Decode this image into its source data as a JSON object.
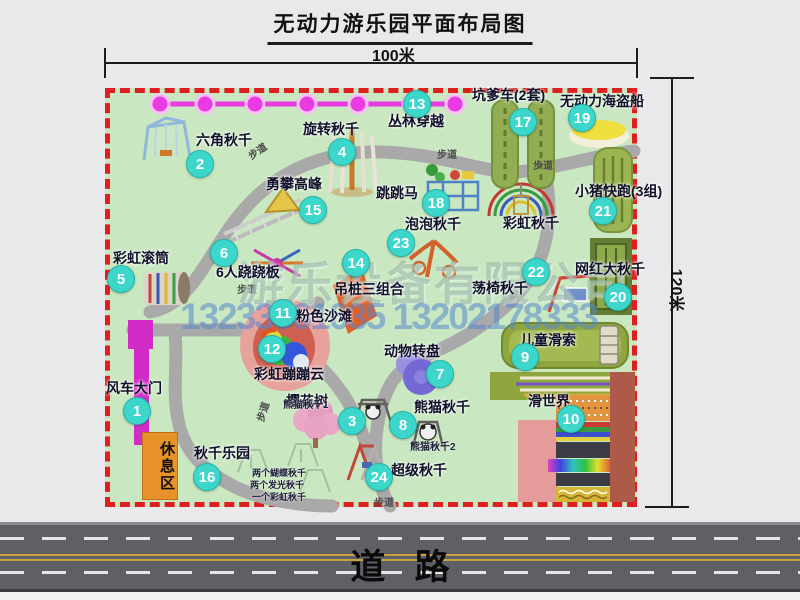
{
  "title": "无动力游乐园平面布局图",
  "dimensions": {
    "width_label": "100米",
    "height_label": "120米"
  },
  "road": {
    "label": "道   路"
  },
  "watermark": {
    "company": "游乐设备有限公司",
    "phones": "13233861635 13202178333"
  },
  "rest_area_label": "休息区",
  "colors": {
    "map_background": "#c9e7c0",
    "map_border": "#de1f1f",
    "marker": "#3cd6cb",
    "gate": "#d22cc6",
    "rest_area": "#e8922a",
    "road": "#5f5f66",
    "chain": "#ea3be2"
  },
  "map": {
    "pois": [
      {
        "num": "1",
        "label": "风车大门",
        "cx": 137,
        "cy": 411,
        "lx": 106,
        "ly": 381
      },
      {
        "num": "2",
        "label": "六角秋千",
        "cx": 200,
        "cy": 164,
        "lx": 196,
        "ly": 133
      },
      {
        "num": "3",
        "label": "樱花树",
        "cx": 352,
        "cy": 421,
        "lx": 286,
        "ly": 394
      },
      {
        "num": "4",
        "label": "旋转秋千",
        "cx": 342,
        "cy": 152,
        "lx": 303,
        "ly": 122
      },
      {
        "num": "5",
        "label": "彩虹滚筒",
        "cx": 121,
        "cy": 279,
        "lx": 113,
        "ly": 251
      },
      {
        "num": "6",
        "label": "6人跷跷板",
        "cx": 224,
        "cy": 253,
        "lx": 216,
        "ly": 265
      },
      {
        "num": "7",
        "label": "动物转盘",
        "cx": 440,
        "cy": 374,
        "lx": 384,
        "ly": 344
      },
      {
        "num": "8",
        "label": "熊猫秋千",
        "cx": 403,
        "cy": 425,
        "lx": 414,
        "ly": 400
      },
      {
        "num": "9",
        "label": "儿童滑索",
        "cx": 525,
        "cy": 357,
        "lx": 520,
        "ly": 333
      },
      {
        "num": "10",
        "label": "滑世界",
        "cx": 571,
        "cy": 419,
        "lx": 528,
        "ly": 394
      },
      {
        "num": "11",
        "label": "粉色沙滩",
        "cx": 283,
        "cy": 313,
        "lx": 296,
        "ly": 309
      },
      {
        "num": "12",
        "label": "彩虹蹦蹦云",
        "cx": 272,
        "cy": 349,
        "lx": 254,
        "ly": 367
      },
      {
        "num": "13",
        "label": "丛林穿越",
        "cx": 417,
        "cy": 104,
        "lx": 388,
        "ly": 114
      },
      {
        "num": "14",
        "label": "吊桩三组合",
        "cx": 356,
        "cy": 263,
        "lx": 334,
        "ly": 282
      },
      {
        "num": "15",
        "label": "勇攀高峰",
        "cx": 313,
        "cy": 210,
        "lx": 266,
        "ly": 177
      },
      {
        "num": "16",
        "label": "秋千乐园",
        "cx": 207,
        "cy": 477,
        "lx": 194,
        "ly": 446
      },
      {
        "num": "17",
        "label": "坑爹车(2套)",
        "cx": 523,
        "cy": 122,
        "lx": 472,
        "ly": 88
      },
      {
        "num": "18",
        "label": "跳跳马",
        "cx": 436,
        "cy": 203,
        "lx": 376,
        "ly": 186
      },
      {
        "num": "19",
        "label": "无动力海盗船",
        "cx": 582,
        "cy": 118,
        "lx": 560,
        "ly": 94
      },
      {
        "num": "20",
        "label": "网红大秋千",
        "cx": 618,
        "cy": 297,
        "lx": 575,
        "ly": 262
      },
      {
        "num": "21",
        "label": "小猪快跑(3组)",
        "cx": 603,
        "cy": 211,
        "lx": 575,
        "ly": 184
      },
      {
        "num": "22",
        "label": "荡椅秋千",
        "cx": 536,
        "cy": 272,
        "lx": 472,
        "ly": 281
      },
      {
        "num": "23",
        "label": "泡泡秋千",
        "cx": 401,
        "cy": 243,
        "lx": 405,
        "ly": 217
      },
      {
        "num": "24",
        "label": "超级秋千",
        "cx": 379,
        "cy": 477,
        "lx": 391,
        "ly": 463
      }
    ],
    "plain_labels": [
      {
        "text": "彩虹秋千",
        "x": 503,
        "y": 216
      }
    ],
    "path_labels": [
      {
        "text": "步道",
        "x": 247,
        "y": 143,
        "rot": -35
      },
      {
        "text": "步道",
        "x": 437,
        "y": 146,
        "rot": 0
      },
      {
        "text": "步道",
        "x": 533,
        "y": 157,
        "rot": 0
      },
      {
        "text": "步道",
        "x": 237,
        "y": 281,
        "rot": 0
      },
      {
        "text": "步道",
        "x": 252,
        "y": 404,
        "rot": -72
      },
      {
        "text": "步道",
        "x": 374,
        "y": 494,
        "rot": 0
      }
    ],
    "sub_labels": [
      {
        "text": "熊猫秋千1",
        "x": 283,
        "y": 400,
        "size": 10
      },
      {
        "text": "熊猫秋千2",
        "x": 410,
        "y": 442,
        "size": 10
      },
      {
        "text": "两个蝴蝶秋千",
        "x": 252,
        "y": 469,
        "size": 9
      },
      {
        "text": "两个发光秋千",
        "x": 250,
        "y": 481,
        "size": 9
      },
      {
        "text": "一个彩虹秋千",
        "x": 252,
        "y": 493,
        "size": 9
      }
    ]
  }
}
